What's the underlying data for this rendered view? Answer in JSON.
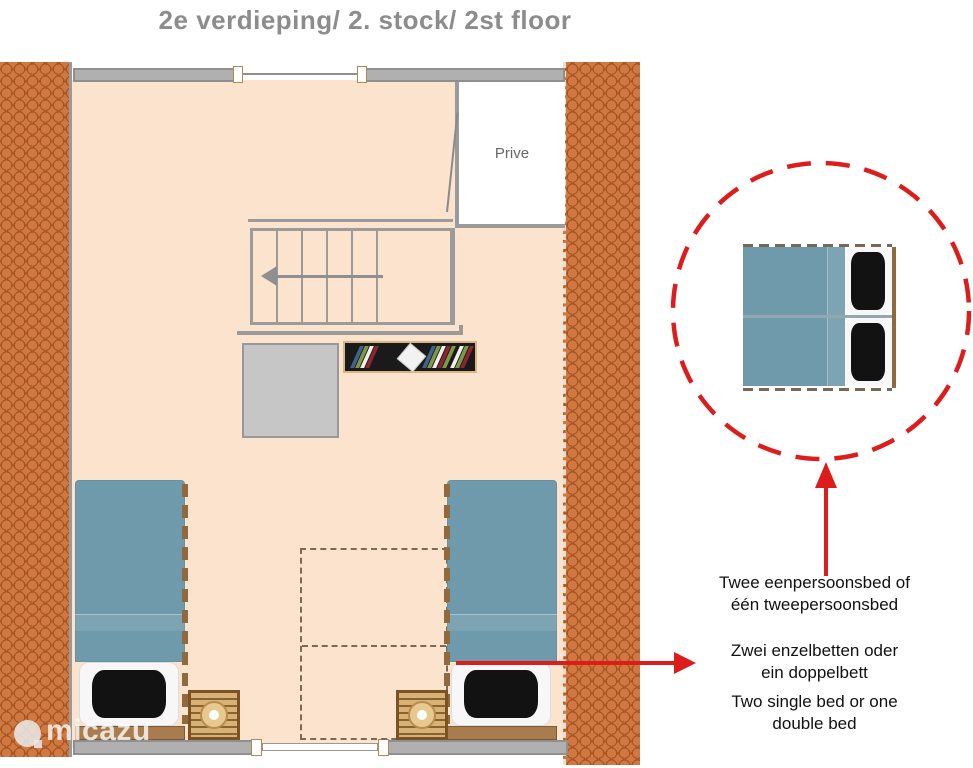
{
  "title": "2e verdieping/ 2. stock/ 2st floor",
  "plan": {
    "room_label": "Prive",
    "colors": {
      "floor": "#fbe3cd",
      "roof_tile": "#d17842",
      "wall": "#b0b0b0",
      "bed_blanket": "#6f9aab",
      "pillow": "#121212",
      "wood": "#d7b276",
      "closet": "#c6c6c6",
      "accent_red": "#dd1c1c",
      "title_gray": "#8c8c8c"
    },
    "icons": {
      "stairs_direction": "arrow-left-icon",
      "detail_pointer": "arrow-up-icon",
      "bed_label_pointer": "arrow-right-icon",
      "watermark_logo": "micazu-bubble-icon"
    }
  },
  "annotations": {
    "dutch": {
      "line1": "Twee eenpersoonsbed of",
      "line2": "één tweepersoonsbed"
    },
    "german": {
      "line1": "Zwei enzelbetten oder",
      "line2": "ein doppelbett"
    },
    "english": {
      "line1": "Two single bed or one",
      "line2": "double bed"
    }
  },
  "watermark": {
    "brand": "micazu"
  }
}
